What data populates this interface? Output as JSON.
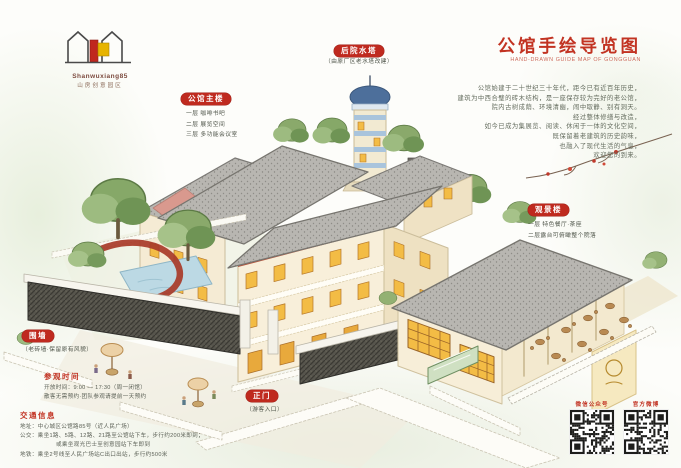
{
  "colors": {
    "accent_red": "#c23322",
    "badge_red": "#bf2a1f"
  },
  "logo": {
    "en": "Shanwuxiang85",
    "cn": "山房创意园区"
  },
  "header": {
    "title": "公馆手绘导览图",
    "subtitle": "HAND-DRAWN GUIDE MAP OF GONGGUAN",
    "intro_lines": [
      "公馆始建于二十世纪三十年代，距今已有近百年历史，",
      "建筑为中西合璧的砖木结构，是一座保存较为完好的老公馆，",
      "院内古树成荫、环境清幽，闹中取静、别有洞天。",
      "经过整体修缮与改造，",
      "如今已成为集展览、阅读、休闲于一体的文化空间，",
      "既保留着老建筑的历史韵味，",
      "也融入了现代生活的气息，",
      "欢迎您的到来。"
    ]
  },
  "labels": {
    "water_tower": {
      "badge": "后院水塔",
      "caption": "（由原厂区老水塔改建）"
    },
    "main_building": {
      "badge": "公馆主楼",
      "lines": [
        "一层 咖啡书吧",
        "二层 展览空间",
        "三层 多功能会议室"
      ]
    },
    "view_building": {
      "badge": "观景楼",
      "lines": [
        "一层 特色餐厅·茶座",
        "二层露台可俯瞰整个院落"
      ]
    },
    "wall": {
      "badge": "围墙",
      "caption": "（老砖墙·保留原有风貌）"
    },
    "gate": {
      "badge": "正门",
      "caption": "（游客入口）"
    }
  },
  "info": {
    "hours": {
      "heading": "参观时间",
      "lines": [
        "开放时间：9:00 — 17:30（周一闭馆）",
        "散客无需预约·团队参观请提前一天预约"
      ]
    },
    "traffic": {
      "heading": "交通信息",
      "lines": [
        "地址：中心城区公馆路85号（近人民广场）",
        "公交：乘坐1路、5路、12路、21路至公馆站下车，步行约200米即到；",
        "或乘坐观光巴士至创意园站下车即到",
        "地铁：乘坐2号线至人民广场站C出口出站，步行约500米"
      ]
    }
  },
  "qr": {
    "left_label": "微信公众号",
    "right_label": "官方微博"
  }
}
